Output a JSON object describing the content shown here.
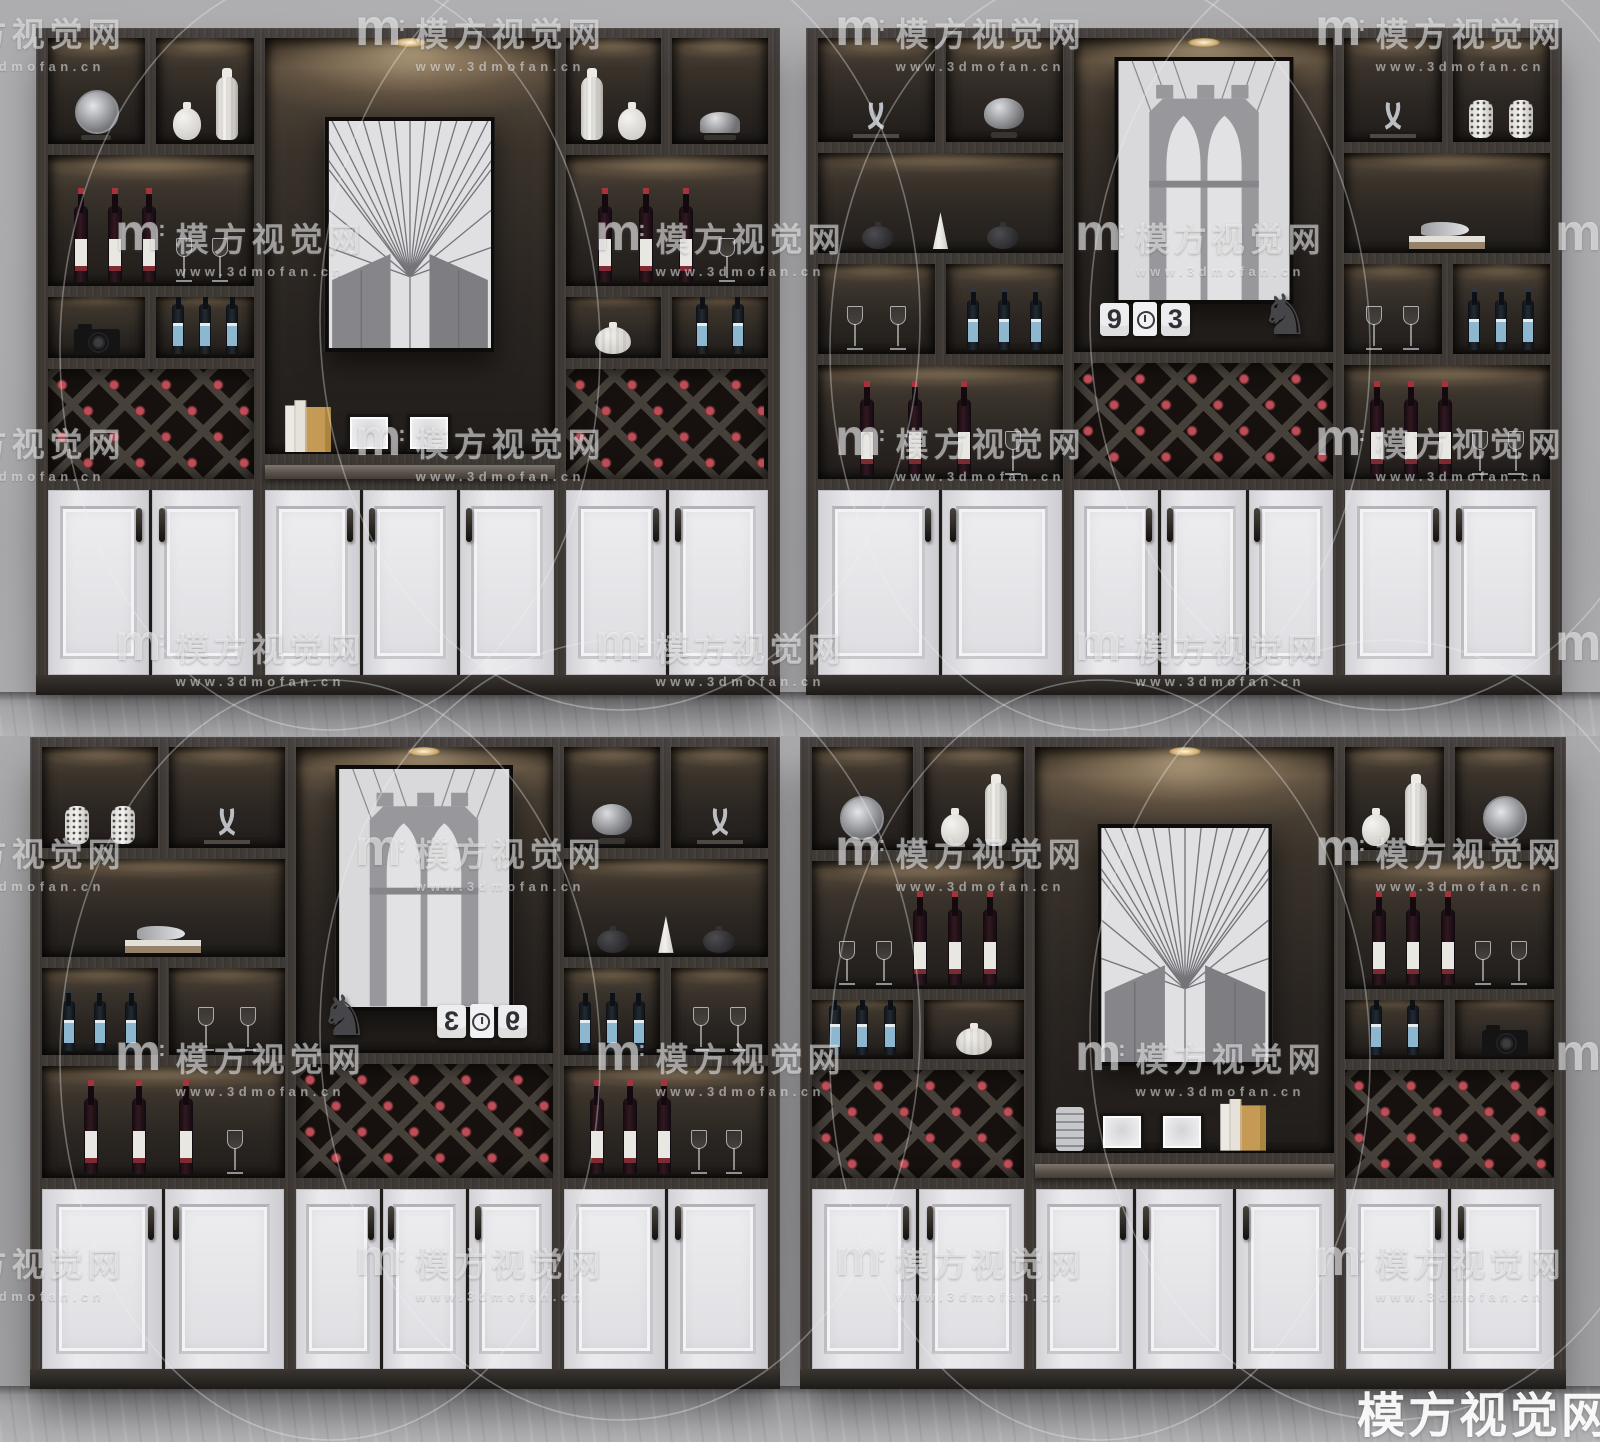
{
  "scene": {
    "description": "3D interior render collage: four dark wood wine display cabinets with lit shelving niches, framed black-and-white Brooklyn Bridge photos, diamond wine racks holding red-capped bottles, decorative vases, sculptures, glasses, and white paneled lower doors, arranged two by two on a grey wall with grey marble floor",
    "colors": {
      "wall": "#b0afb2",
      "floor": "#a3a2a5",
      "wood_frame": "#403b37",
      "niche_shadow": "#27221e",
      "warm_shelf_light": "#a8906c",
      "door_white": "#e4e4e7",
      "plinth": "#332f2b",
      "rack_background": "#16110e",
      "rack_lattice": "#46403a",
      "bottle_cap_red": "#c4525a",
      "bottle_label_blue": "#8db7cf",
      "metal_silver": "#c3c4c7",
      "photo_monochrome": "#dfdfe1"
    }
  },
  "watermark": {
    "logo": "m",
    "logo_colon": ":",
    "brand": "模方视觉网",
    "url": "www.3dmofan.cn",
    "corner_text": "模方视觉网",
    "tile_rows": 7,
    "tile_row_start_y": 8,
    "tile_row_step": 205,
    "tile_even_x": [
      -125,
      355,
      835,
      1315
    ],
    "tile_odd_x": [
      115,
      595,
      1075,
      1555
    ]
  },
  "cabinets": [
    {
      "id": "cabinet-top-left",
      "variant": "side-racks",
      "columns": {
        "left": [
          {
            "h": 26,
            "split": [
              {
                "items": [
                  "disc-ornament"
                ]
              },
              {
                "items": [
                  "vase-round",
                  "vase-tall"
                ]
              }
            ]
          },
          {
            "h": 32,
            "items": [
              "bottle-red",
              "bottle-red",
              "bottle-red",
              "glass",
              "glass"
            ]
          },
          {
            "h": 15,
            "split": [
              {
                "items": [
                  "camera"
                ]
              },
              {
                "items": [
                  "bottle-blue",
                  "bottle-blue",
                  "bottle-blue"
                ]
              }
            ]
          },
          {
            "h": 27,
            "rack": true
          }
        ],
        "right": [
          {
            "h": 26,
            "split": [
              {
                "items": [
                  "vase-tall",
                  "vase-round"
                ]
              },
              {
                "items": [
                  "dish-dome"
                ]
              }
            ]
          },
          {
            "h": 32,
            "items": [
              "bottle-red",
              "bottle-red",
              "bottle-red",
              "glass"
            ]
          },
          {
            "h": 15,
            "split": [
              {
                "items": [
                  "vase-pumpkin"
                ]
              },
              {
                "items": [
                  "bottle-blue",
                  "bottle-blue"
                ]
              }
            ]
          },
          {
            "h": 27,
            "rack": true
          }
        ]
      },
      "center": {
        "photo": "bridge-cables",
        "counter_items": [
          "books",
          "frame-small",
          "frame-small"
        ]
      },
      "doors": [
        2,
        3,
        2
      ]
    },
    {
      "id": "cabinet-top-right",
      "variant": "center-rack",
      "columns": {
        "left": [
          {
            "h": 25.5,
            "split": [
              {
                "items": [
                  "antlers"
                ]
              },
              {
                "items": [
                  "helmet-ornament"
                ]
              }
            ]
          },
          {
            "h": 24.5,
            "items": [
              "dark-vase",
              "cone-white",
              "dark-vase"
            ]
          },
          {
            "h": 22,
            "split": [
              {
                "items": [
                  "glass",
                  "glass"
                ]
              },
              {
                "items": [
                  "bottle-blue",
                  "bottle-blue",
                  "bottle-blue"
                ]
              }
            ]
          },
          {
            "h": 28,
            "items": [
              "bottle-red",
              "bottle-red",
              "bottle-red",
              "glass"
            ]
          }
        ],
        "right": [
          {
            "h": 25.5,
            "split": [
              {
                "items": [
                  "antlers"
                ]
              },
              {
                "items": [
                  "vase-perforated",
                  "vase-perforated"
                ]
              }
            ]
          },
          {
            "h": 24.5,
            "items": [
              "bird-on-books"
            ]
          },
          {
            "h": 22,
            "split": [
              {
                "items": [
                  "glass",
                  "glass"
                ]
              },
              {
                "items": [
                  "bottle-blue",
                  "bottle-blue",
                  "bottle-blue"
                ]
              }
            ]
          },
          {
            "h": 28,
            "items": [
              "bottle-red",
              "bottle-red",
              "bottle-red",
              "glass",
              "glass"
            ]
          }
        ]
      },
      "center": {
        "photo": "bridge-tower",
        "clock_digits": [
          "9",
          "3"
        ],
        "clock_mirrored": false,
        "horse": true
      },
      "doors": [
        2,
        3,
        2
      ]
    },
    {
      "id": "cabinet-bottom-left",
      "variant": "center-rack",
      "columns": {
        "left": [
          {
            "h": 25.5,
            "split": [
              {
                "items": [
                  "vase-perforated",
                  "vase-perforated"
                ]
              },
              {
                "items": [
                  "antlers"
                ]
              }
            ]
          },
          {
            "h": 24.5,
            "items": [
              "bird-on-books"
            ]
          },
          {
            "h": 22,
            "split": [
              {
                "items": [
                  "bottle-blue",
                  "bottle-blue",
                  "bottle-blue"
                ]
              },
              {
                "items": [
                  "glass",
                  "glass"
                ]
              }
            ]
          },
          {
            "h": 28,
            "items": [
              "bottle-red",
              "bottle-red",
              "bottle-red",
              "glass"
            ]
          }
        ],
        "right": [
          {
            "h": 25.5,
            "split": [
              {
                "items": [
                  "helmet-ornament"
                ]
              },
              {
                "items": [
                  "antlers"
                ]
              }
            ]
          },
          {
            "h": 24.5,
            "items": [
              "dark-vase",
              "cone-white",
              "dark-vase"
            ]
          },
          {
            "h": 22,
            "split": [
              {
                "items": [
                  "bottle-blue",
                  "bottle-blue",
                  "bottle-blue"
                ]
              },
              {
                "items": [
                  "glass",
                  "glass"
                ]
              }
            ]
          },
          {
            "h": 28,
            "items": [
              "bottle-red",
              "bottle-red",
              "bottle-red",
              "glass",
              "glass"
            ]
          }
        ]
      },
      "center": {
        "photo": "bridge-tower",
        "clock_digits": [
          "9",
          "3"
        ],
        "clock_mirrored": true,
        "horse": true
      },
      "doors": [
        2,
        3,
        2
      ]
    },
    {
      "id": "cabinet-bottom-right",
      "variant": "side-racks",
      "columns": {
        "left": [
          {
            "h": 26,
            "split": [
              {
                "items": [
                  "disc-ornament"
                ]
              },
              {
                "items": [
                  "vase-round",
                  "vase-tall"
                ]
              }
            ]
          },
          {
            "h": 32,
            "items": [
              "glass",
              "glass",
              "bottle-red",
              "bottle-red",
              "bottle-red"
            ]
          },
          {
            "h": 15,
            "split": [
              {
                "items": [
                  "bottle-blue",
                  "bottle-blue",
                  "bottle-blue"
                ]
              },
              {
                "items": [
                  "vase-pumpkin"
                ]
              }
            ]
          },
          {
            "h": 27,
            "rack": true
          }
        ],
        "right": [
          {
            "h": 26,
            "split": [
              {
                "items": [
                  "vase-round",
                  "vase-tall"
                ]
              },
              {
                "items": [
                  "disc-ornament"
                ]
              }
            ]
          },
          {
            "h": 32,
            "items": [
              "bottle-red",
              "bottle-red",
              "bottle-red",
              "glass",
              "glass"
            ]
          },
          {
            "h": 15,
            "split": [
              {
                "items": [
                  "bottle-blue",
                  "bottle-blue"
                ]
              },
              {
                "items": [
                  "camera"
                ]
              }
            ]
          },
          {
            "h": 27,
            "rack": true
          }
        ]
      },
      "center": {
        "photo": "bridge-cables",
        "counter_items": [
          "cup-stack",
          "frame-small",
          "frame-small",
          "books"
        ]
      },
      "doors": [
        2,
        3,
        2
      ]
    }
  ]
}
